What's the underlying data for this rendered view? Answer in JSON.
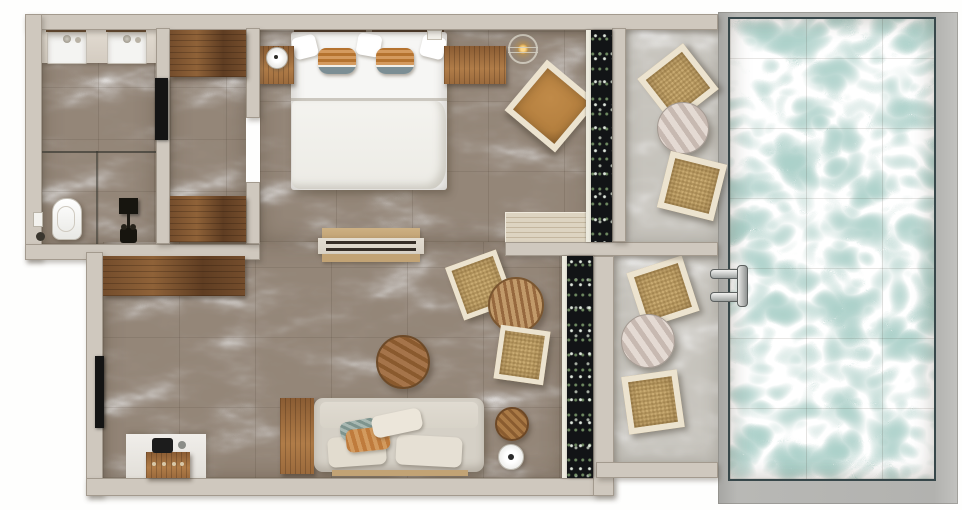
{
  "scene": {
    "type": "apartment-floor-plan-render",
    "view": "top-down",
    "rooms": [
      {
        "name": "bathroom",
        "items": [
          "vanity-counter",
          "sink-left",
          "sink-right",
          "glass-partition",
          "toilet",
          "flush-plate",
          "shower-column"
        ]
      },
      {
        "name": "wardrobe-hall",
        "items": [
          "closet-top",
          "closet-bottom",
          "bathroom-door"
        ]
      },
      {
        "name": "bedroom",
        "items": [
          "double-bed",
          "white-pillows",
          "striped-cushions",
          "nightstand-left",
          "table-lamp",
          "nightstand-right",
          "gold-pendant-lamp",
          "accent-chair",
          "wood-floor-mat",
          "window-curtain"
        ]
      },
      {
        "name": "living-room",
        "items": [
          "wall-shelf",
          "console-table",
          "desk",
          "storage-chest",
          "sofa",
          "throw-pillows",
          "coffee-table",
          "dining-table",
          "rattan-chair-upper",
          "rattan-chair-lower",
          "side-table",
          "floor-lamp",
          "entry-door",
          "window-curtain"
        ]
      },
      {
        "name": "terrace-upper",
        "items": [
          "lounge-chair-1",
          "round-table-1",
          "lounge-chair-2"
        ]
      },
      {
        "name": "terrace-lower",
        "items": [
          "lounge-chair-3",
          "round-table-2",
          "lounge-chair-4"
        ]
      },
      {
        "name": "pool",
        "items": [
          "pool-deck",
          "pool-water",
          "pool-ladder"
        ]
      }
    ]
  },
  "colors": {
    "wall": "#cfc8be",
    "wallEdge": "#a39a8e",
    "marble": "#948678",
    "stone": "#c6c3bc",
    "water": "#aad0c9",
    "deck": "#b2b2af",
    "poolEdge": "#37474a",
    "woodDark": "#744d2c",
    "woodMid": "#9b6a3c",
    "woodLight": "#ddd4c1",
    "chairFrame": "#ece3cf",
    "chairSeat": "#c9ab72",
    "seatBrown": "#b5803f",
    "bedWhite": "#f6f6f4",
    "sofaBody": "#d5d0c6",
    "cushionCream": "#e2dccf",
    "pillowOrange": "#bf7b3c",
    "pillowTeal": "#7e948e",
    "fixtureBlack": "#17150f",
    "doorBlack": "#141414",
    "porcelain": "#f4f4f2",
    "curtain": "#121416",
    "consoleCream": "#d8d1c5",
    "consoleTan": "#c2a375",
    "gold": "#c79645"
  }
}
